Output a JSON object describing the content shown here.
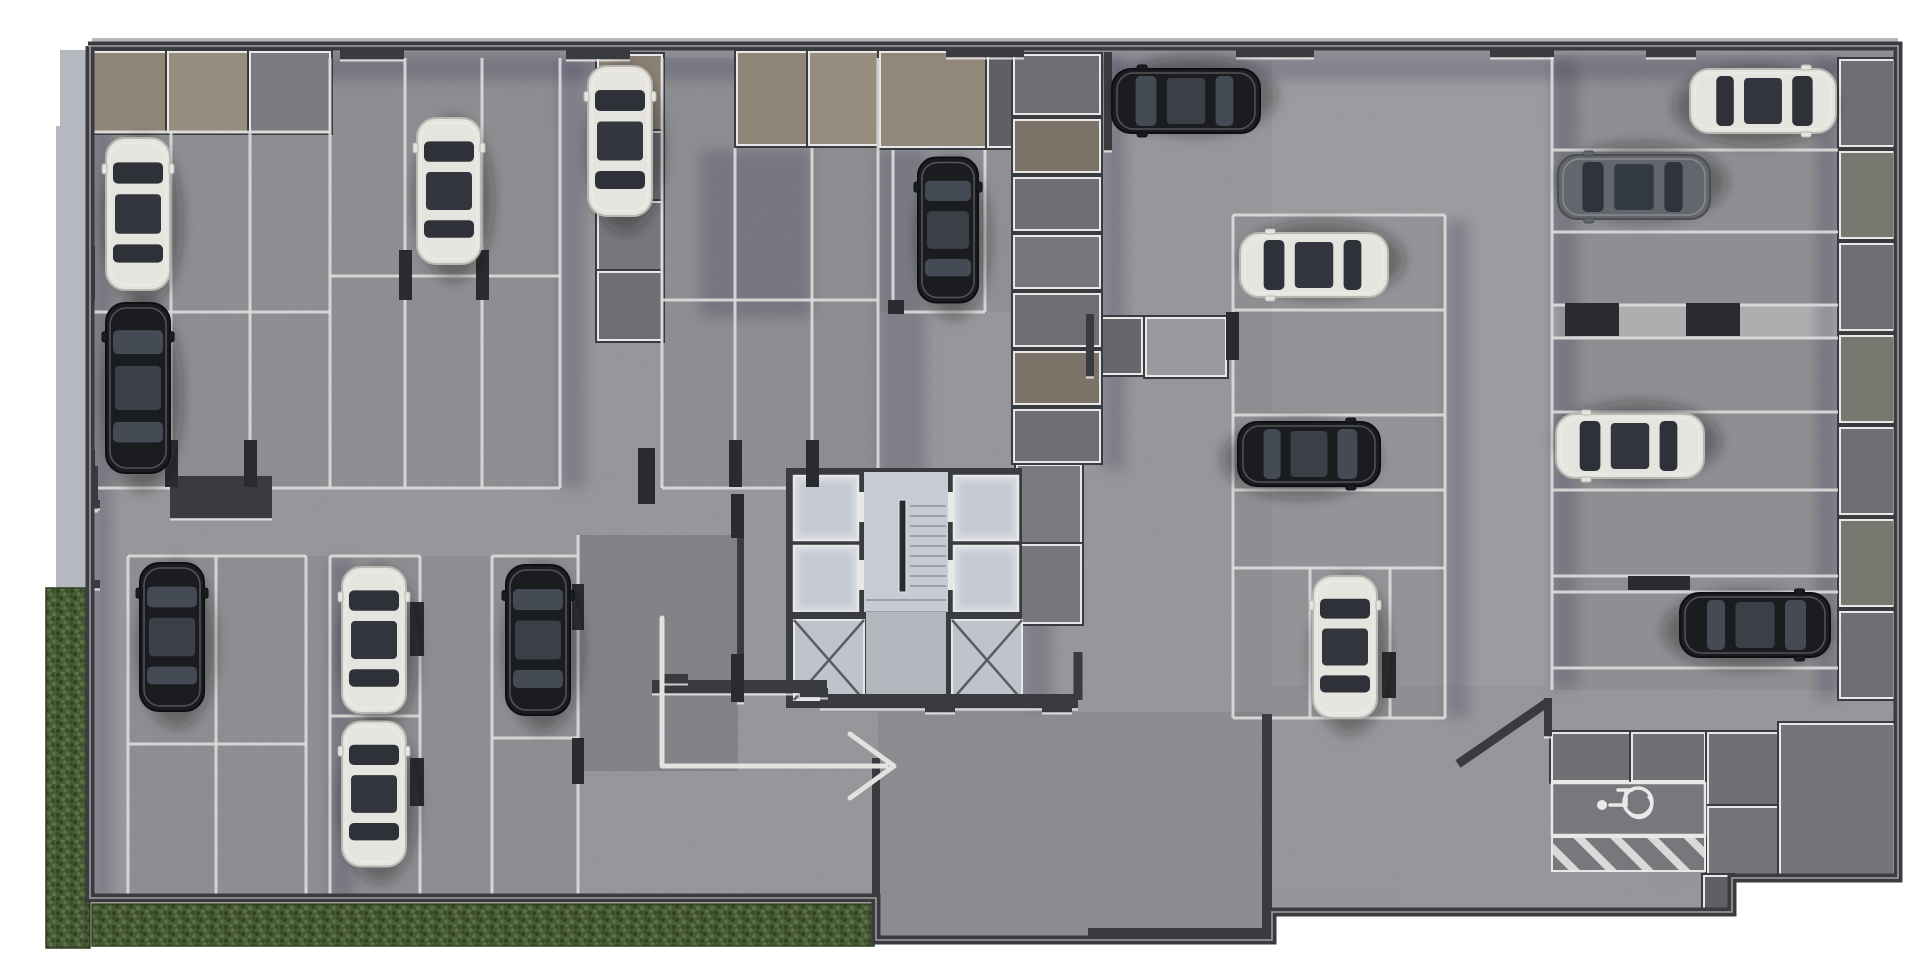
{
  "meta": {
    "type": "parking-garage-floor-plan-render",
    "view": "top-down",
    "visible_text": [],
    "car_count": 17,
    "accessible_stall_count": 1
  },
  "colors": {
    "page": "#ffffff",
    "floor": "#96969a",
    "floor_light": "#a2a2a6",
    "wall": "#3a3b3f",
    "wall_dark": "#2a2b2e",
    "trim": "#e8e8e8",
    "stall_line": "#dcdcdc",
    "room_gray": "#707175",
    "room_gray2": "#7b7c80",
    "room_tan": "#8f8678",
    "room_tan2": "#968d7f",
    "sidewalk": "#b5b8be",
    "grass": "#42533366",
    "grass_base": "#485b38",
    "grass_dark": "#31421f",
    "grass_light": "#5d7243",
    "elevator_floor": "#d6dae1",
    "stair_floor": "#c6cbd4",
    "lobby_floor": "#b2b6bd",
    "shaft_floor": "#bfc4cc",
    "concrete_strip": "#aeaeb1",
    "car_white": "#e6e4df",
    "car_black": "#1b1c20",
    "car_gray": "#63666c",
    "glass_dark": "#2e3138",
    "glass_light": "#454b55",
    "arrow": "#e3e2de",
    "icon_white": "#e9e9ea"
  },
  "plan": {
    "width": 1920,
    "height": 960,
    "footprint": [
      [
        88,
        46
      ],
      [
        1898,
        46
      ],
      [
        1898,
        878
      ],
      [
        1732,
        878
      ],
      [
        1732,
        912
      ],
      [
        1272,
        912
      ],
      [
        1272,
        940
      ],
      [
        876,
        940
      ],
      [
        876,
        898
      ],
      [
        90,
        898
      ],
      [
        90,
        46
      ]
    ],
    "sidewalks": [
      {
        "x": 56,
        "y": 126,
        "w": 32,
        "h": 462
      },
      {
        "x": 60,
        "y": 50,
        "w": 28,
        "h": 78
      },
      {
        "x": 92,
        "y": 38,
        "w": 1806,
        "h": 8
      }
    ],
    "grass": [
      {
        "x": 46,
        "y": 588,
        "w": 44,
        "h": 360
      },
      {
        "x": 92,
        "y": 904,
        "w": 782,
        "h": 42
      },
      {
        "x": 1476,
        "y": 882,
        "w": 230,
        "h": 31
      }
    ],
    "zones": [
      {
        "x": 92,
        "y": 52,
        "w": 468,
        "h": 436,
        "fill": "rgba(40,42,48,0.08)"
      },
      {
        "x": 662,
        "y": 58,
        "w": 216,
        "h": 430,
        "fill": "rgba(40,42,48,0.08)"
      },
      {
        "x": 878,
        "y": 52,
        "w": 134,
        "h": 260,
        "fill": "rgba(40,42,48,0.06)"
      },
      {
        "x": 128,
        "y": 556,
        "w": 450,
        "h": 344,
        "fill": "rgba(40,42,48,0.08)"
      },
      {
        "x": 1552,
        "y": 55,
        "w": 286,
        "h": 635,
        "fill": "rgba(40,42,48,0.07)"
      },
      {
        "x": 1233,
        "y": 215,
        "w": 212,
        "h": 503,
        "fill": "rgba(40,42,48,0.07)"
      },
      {
        "x": 1272,
        "y": 58,
        "w": 278,
        "h": 628,
        "fill": "rgba(255,255,255,0.05)"
      },
      {
        "x": 878,
        "y": 712,
        "w": 386,
        "h": 226,
        "fill": "rgba(50,52,60,0.10)"
      },
      {
        "x": 1552,
        "y": 305,
        "w": 286,
        "h": 33,
        "fill": "#aeaeb1"
      }
    ],
    "ramp": {
      "x": 580,
      "y": 535,
      "w": 158,
      "h": 236,
      "fill": "rgba(48,51,60,0.20)"
    },
    "shadows": [
      {
        "x": 92,
        "y": 56,
        "w": 1800,
        "h": 24
      },
      {
        "x": 92,
        "y": 130,
        "w": 20,
        "h": 768
      },
      {
        "x": 1102,
        "y": 58,
        "w": 24,
        "h": 412
      },
      {
        "x": 1022,
        "y": 472,
        "w": 30,
        "h": 236
      },
      {
        "x": 700,
        "y": 150,
        "w": 112,
        "h": 168
      },
      {
        "x": 878,
        "y": 150,
        "w": 48,
        "h": 336
      },
      {
        "x": 560,
        "y": 60,
        "w": 26,
        "h": 428
      },
      {
        "x": 330,
        "y": 560,
        "w": 24,
        "h": 338
      },
      {
        "x": 1552,
        "y": 60,
        "w": 26,
        "h": 628
      },
      {
        "x": 1816,
        "y": 60,
        "w": 22,
        "h": 640
      },
      {
        "x": 1445,
        "y": 220,
        "w": 24,
        "h": 498
      }
    ],
    "rooms": [
      {
        "x": 92,
        "y": 52,
        "w": 74,
        "h": 80,
        "fill": "#8f8678"
      },
      {
        "x": 168,
        "y": 52,
        "w": 80,
        "h": 80,
        "fill": "#968d7f"
      },
      {
        "x": 250,
        "y": 52,
        "w": 80,
        "h": 80,
        "fill": "#7b7c80"
      },
      {
        "x": 598,
        "y": 55,
        "w": 64,
        "h": 75,
        "fill": "#8a8173"
      },
      {
        "x": 598,
        "y": 132,
        "w": 64,
        "h": 68,
        "fill": "#6e6f73"
      },
      {
        "x": 598,
        "y": 202,
        "w": 64,
        "h": 68,
        "fill": "#76777b"
      },
      {
        "x": 598,
        "y": 272,
        "w": 64,
        "h": 68,
        "fill": "#6e6f73"
      },
      {
        "x": 737,
        "y": 52,
        "w": 70,
        "h": 93,
        "fill": "#8f8678"
      },
      {
        "x": 809,
        "y": 52,
        "w": 69,
        "h": 93,
        "fill": "#968d7f"
      },
      {
        "x": 880,
        "y": 52,
        "w": 106,
        "h": 95,
        "fill": "#91887a"
      },
      {
        "x": 988,
        "y": 52,
        "w": 24,
        "h": 95,
        "fill": "#5f6064"
      },
      {
        "x": 1017,
        "y": 465,
        "w": 64,
        "h": 78,
        "fill": "#7a7b7f"
      },
      {
        "x": 1017,
        "y": 545,
        "w": 64,
        "h": 78,
        "fill": "#76777b"
      },
      {
        "x": 1090,
        "y": 318,
        "w": 52,
        "h": 56,
        "fill": "#66676b"
      },
      {
        "x": 1146,
        "y": 318,
        "w": 80,
        "h": 58,
        "fill": "#9a9a9e"
      },
      {
        "x": 1552,
        "y": 733,
        "w": 78,
        "h": 48,
        "fill": "#6f7074"
      },
      {
        "x": 1632,
        "y": 733,
        "w": 73,
        "h": 48,
        "fill": "#6f7074"
      },
      {
        "x": 1708,
        "y": 733,
        "w": 70,
        "h": 72,
        "fill": "#6f7074"
      },
      {
        "x": 1708,
        "y": 807,
        "w": 70,
        "h": 72,
        "fill": "#747579"
      },
      {
        "x": 1780,
        "y": 724,
        "w": 114,
        "h": 152,
        "fill": "#747579"
      },
      {
        "x": 1704,
        "y": 876,
        "w": 28,
        "h": 36,
        "fill": "#5f6064"
      }
    ],
    "storage_columns": [
      {
        "x": 1014,
        "y": 55,
        "w": 86,
        "cells": [
          65,
          58,
          58,
          58,
          58,
          58,
          58
        ],
        "fills": [
          "#6e6f73",
          "#7b7268",
          "#6e6f73",
          "#76777b",
          "#6e6f73",
          "#7b7268",
          "#6e6f73"
        ]
      },
      {
        "x": 1840,
        "y": 60,
        "w": 54,
        "cells": [
          92,
          92,
          92,
          92,
          92,
          92,
          92
        ],
        "fills": [
          "#6e6f73",
          "#777870",
          "#6e6f73",
          "#777870",
          "#6e6f73",
          "#777870",
          "#6e6f73"
        ]
      }
    ],
    "stall_lines": [
      [
        92,
        132,
        330,
        132
      ],
      [
        92,
        312,
        330,
        312
      ],
      [
        92,
        488,
        330,
        488
      ],
      [
        171,
        132,
        171,
        488
      ],
      [
        250,
        132,
        250,
        488
      ],
      [
        330,
        58,
        330,
        488
      ],
      [
        330,
        276,
        560,
        276
      ],
      [
        330,
        488,
        560,
        488
      ],
      [
        405,
        58,
        405,
        488
      ],
      [
        482,
        58,
        482,
        488
      ],
      [
        560,
        58,
        560,
        488
      ],
      [
        662,
        58,
        662,
        488
      ],
      [
        735,
        148,
        735,
        488
      ],
      [
        812,
        148,
        812,
        488
      ],
      [
        878,
        58,
        878,
        488
      ],
      [
        662,
        300,
        878,
        300
      ],
      [
        662,
        488,
        878,
        488
      ],
      [
        893,
        150,
        893,
        312
      ],
      [
        985,
        150,
        985,
        312
      ],
      [
        893,
        312,
        985,
        312
      ],
      [
        128,
        556,
        306,
        556
      ],
      [
        330,
        556,
        420,
        556
      ],
      [
        492,
        556,
        578,
        556
      ],
      [
        128,
        556,
        128,
        900
      ],
      [
        216,
        556,
        216,
        900
      ],
      [
        306,
        556,
        306,
        900
      ],
      [
        330,
        556,
        330,
        900
      ],
      [
        420,
        556,
        420,
        900
      ],
      [
        492,
        556,
        492,
        900
      ],
      [
        578,
        535,
        578,
        898
      ],
      [
        128,
        744,
        306,
        744
      ],
      [
        330,
        716,
        420,
        716
      ],
      [
        492,
        738,
        578,
        738
      ],
      [
        1552,
        55,
        1552,
        690
      ],
      [
        1552,
        150,
        1838,
        150
      ],
      [
        1552,
        232,
        1838,
        232
      ],
      [
        1552,
        305,
        1838,
        305
      ],
      [
        1552,
        338,
        1838,
        338
      ],
      [
        1552,
        412,
        1838,
        412
      ],
      [
        1552,
        490,
        1838,
        490
      ],
      [
        1552,
        576,
        1838,
        576
      ],
      [
        1552,
        592,
        1838,
        592
      ],
      [
        1552,
        668,
        1838,
        668
      ],
      [
        1233,
        215,
        1445,
        215
      ],
      [
        1233,
        310,
        1445,
        310
      ],
      [
        1233,
        415,
        1445,
        415
      ],
      [
        1233,
        490,
        1445,
        490
      ],
      [
        1233,
        568,
        1445,
        568
      ],
      [
        1233,
        718,
        1445,
        718
      ],
      [
        1233,
        215,
        1233,
        718
      ],
      [
        1445,
        215,
        1445,
        718
      ],
      [
        1310,
        568,
        1310,
        718
      ],
      [
        1390,
        568,
        1390,
        718
      ]
    ],
    "walls": [
      {
        "x": 340,
        "y": 44,
        "w": 64,
        "h": 15
      },
      {
        "x": 566,
        "y": 44,
        "w": 64,
        "h": 15
      },
      {
        "x": 946,
        "y": 42,
        "w": 78,
        "h": 15
      },
      {
        "x": 1236,
        "y": 42,
        "w": 78,
        "h": 15
      },
      {
        "x": 1490,
        "y": 44,
        "w": 64,
        "h": 13
      },
      {
        "x": 1646,
        "y": 44,
        "w": 50,
        "h": 13
      },
      {
        "x": 84,
        "y": 466,
        "w": 14,
        "h": 44
      },
      {
        "x": 170,
        "y": 476,
        "w": 102,
        "h": 42
      },
      {
        "x": 737,
        "y": 502,
        "w": 7,
        "h": 200
      },
      {
        "x": 652,
        "y": 680,
        "w": 175,
        "h": 13
      },
      {
        "x": 820,
        "y": 694,
        "w": 258,
        "h": 14
      },
      {
        "x": 660,
        "y": 674,
        "w": 28,
        "h": 9
      },
      {
        "x": 800,
        "y": 688,
        "w": 28,
        "h": 9
      },
      {
        "x": 925,
        "y": 702,
        "w": 30,
        "h": 10
      },
      {
        "x": 1042,
        "y": 702,
        "w": 30,
        "h": 10
      },
      {
        "x": 1262,
        "y": 714,
        "w": 10,
        "h": 226
      },
      {
        "x": 1088,
        "y": 928,
        "w": 184,
        "h": 13
      },
      {
        "x": 872,
        "y": 758,
        "w": 8,
        "h": 182
      },
      {
        "x": 1104,
        "y": 52,
        "w": 8,
        "h": 98
      },
      {
        "x": 1544,
        "y": 698,
        "w": 8,
        "h": 38
      },
      {
        "x": 1086,
        "y": 314,
        "w": 8,
        "h": 62
      },
      {
        "x": 56,
        "y": 500,
        "w": 44,
        "h": 8
      },
      {
        "x": 56,
        "y": 580,
        "w": 44,
        "h": 8
      },
      {
        "x": 56,
        "y": 500,
        "w": 8,
        "h": 88
      }
    ],
    "diag_walls": [
      {
        "x1": 1458,
        "y1": 764,
        "x2": 1548,
        "y2": 702,
        "wd": 9
      },
      {
        "x1": 1078,
        "y1": 652,
        "x2": 1078,
        "y2": 700,
        "wd": 9
      }
    ],
    "pillars": [
      {
        "x": 84,
        "y": 246,
        "w": 11,
        "h": 54
      },
      {
        "x": 84,
        "y": 450,
        "w": 11,
        "h": 54
      },
      {
        "x": 165,
        "y": 440,
        "w": 13,
        "h": 47
      },
      {
        "x": 244,
        "y": 440,
        "w": 13,
        "h": 47
      },
      {
        "x": 399,
        "y": 250,
        "w": 13,
        "h": 50
      },
      {
        "x": 476,
        "y": 250,
        "w": 13,
        "h": 50
      },
      {
        "x": 638,
        "y": 448,
        "w": 17,
        "h": 56
      },
      {
        "x": 729,
        "y": 440,
        "w": 13,
        "h": 47
      },
      {
        "x": 806,
        "y": 440,
        "w": 13,
        "h": 47
      },
      {
        "x": 888,
        "y": 300,
        "w": 16,
        "h": 14
      },
      {
        "x": 1226,
        "y": 312,
        "w": 13,
        "h": 48
      },
      {
        "x": 572,
        "y": 584,
        "w": 12,
        "h": 46
      },
      {
        "x": 572,
        "y": 738,
        "w": 12,
        "h": 46
      },
      {
        "x": 731,
        "y": 494,
        "w": 13,
        "h": 44
      },
      {
        "x": 731,
        "y": 654,
        "w": 13,
        "h": 48
      },
      {
        "x": 410,
        "y": 602,
        "w": 14,
        "h": 54
      },
      {
        "x": 410,
        "y": 758,
        "w": 14,
        "h": 48
      },
      {
        "x": 1565,
        "y": 303,
        "w": 54,
        "h": 33
      },
      {
        "x": 1686,
        "y": 303,
        "w": 54,
        "h": 33
      },
      {
        "x": 1628,
        "y": 576,
        "w": 62,
        "h": 14
      },
      {
        "x": 1382,
        "y": 652,
        "w": 14,
        "h": 46
      }
    ],
    "core": {
      "slab_top": {
        "x": 786,
        "y": 468,
        "w": 236,
        "h": 150
      },
      "stair_floor": {
        "x": 864,
        "y": 472,
        "w": 84,
        "h": 142
      },
      "elevators": [
        {
          "x": 794,
          "y": 476,
          "w": 64,
          "h": 64
        },
        {
          "x": 794,
          "y": 546,
          "w": 64,
          "h": 66
        },
        {
          "x": 954,
          "y": 476,
          "w": 64,
          "h": 64
        },
        {
          "x": 954,
          "y": 546,
          "w": 64,
          "h": 66
        }
      ],
      "door_trims": [
        {
          "x": 858,
          "y": 492,
          "w": 6,
          "h": 30
        },
        {
          "x": 858,
          "y": 560,
          "w": 6,
          "h": 30
        },
        {
          "x": 948,
          "y": 492,
          "w": 6,
          "h": 30
        },
        {
          "x": 948,
          "y": 560,
          "w": 6,
          "h": 30
        }
      ],
      "slab_bottom": {
        "x": 786,
        "y": 612,
        "w": 236,
        "h": 96
      },
      "lobby_gap": {
        "x": 866,
        "y": 612,
        "w": 80,
        "h": 96
      },
      "shafts": [
        {
          "x": 794,
          "y": 620,
          "w": 70,
          "h": 80
        },
        {
          "x": 952,
          "y": 620,
          "w": 70,
          "h": 80
        }
      ],
      "stairs": {
        "rail": {
          "x": 899,
          "y": 500,
          "w": 7,
          "h": 92
        },
        "treads_right": {
          "x1": 910,
          "x2": 946,
          "y": 506,
          "n": 9,
          "dy": 10
        },
        "treads_full": {
          "x1": 866,
          "x2": 946,
          "y": 600,
          "n": 5,
          "dy": 12
        }
      }
    },
    "cars": [
      {
        "cx": 138,
        "cy": 214,
        "a": 0,
        "c": "white",
        "len": 152
      },
      {
        "cx": 138,
        "cy": 388,
        "a": 0,
        "c": "black",
        "len": 170
      },
      {
        "cx": 449,
        "cy": 191,
        "a": 0,
        "c": "white",
        "len": 146
      },
      {
        "cx": 620,
        "cy": 141,
        "a": 0,
        "c": "white",
        "len": 150
      },
      {
        "cx": 948,
        "cy": 230,
        "a": 0,
        "c": "black",
        "len": 145,
        "wid": 60
      },
      {
        "cx": 1186,
        "cy": 101,
        "a": -90,
        "c": "black",
        "len": 148
      },
      {
        "cx": 1314,
        "cy": 265,
        "a": -90,
        "c": "white",
        "len": 148
      },
      {
        "cx": 1309,
        "cy": 454,
        "a": 90,
        "c": "black",
        "len": 142
      },
      {
        "cx": 1345,
        "cy": 647,
        "a": 0,
        "c": "white",
        "len": 142
      },
      {
        "cx": 1763,
        "cy": 101,
        "a": 90,
        "c": "white",
        "len": 146
      },
      {
        "cx": 1634,
        "cy": 187,
        "a": -90,
        "c": "gray",
        "len": 152
      },
      {
        "cx": 1630,
        "cy": 446,
        "a": -90,
        "c": "white",
        "len": 148
      },
      {
        "cx": 1755,
        "cy": 625,
        "a": 90,
        "c": "black",
        "len": 150
      },
      {
        "cx": 172,
        "cy": 637,
        "a": 0,
        "c": "black",
        "len": 148
      },
      {
        "cx": 374,
        "cy": 640,
        "a": 0,
        "c": "white",
        "len": 146
      },
      {
        "cx": 374,
        "cy": 794,
        "a": 0,
        "c": "white",
        "len": 145
      },
      {
        "cx": 538,
        "cy": 640,
        "a": 0,
        "c": "black",
        "len": 150
      }
    ],
    "arrow": {
      "pts": [
        [
          662,
          618
        ],
        [
          662,
          766
        ],
        [
          886,
          766
        ]
      ],
      "head": [
        [
          850,
          734
        ],
        [
          894,
          766
        ],
        [
          850,
          798
        ]
      ],
      "width": 5
    },
    "accessible": {
      "stall": {
        "x": 1552,
        "y": 783,
        "w": 153,
        "h": 52
      },
      "hatch": {
        "x": 1552,
        "y": 837,
        "w": 153,
        "h": 34
      },
      "icon": {
        "cx": 1622,
        "cy": 806
      }
    }
  }
}
